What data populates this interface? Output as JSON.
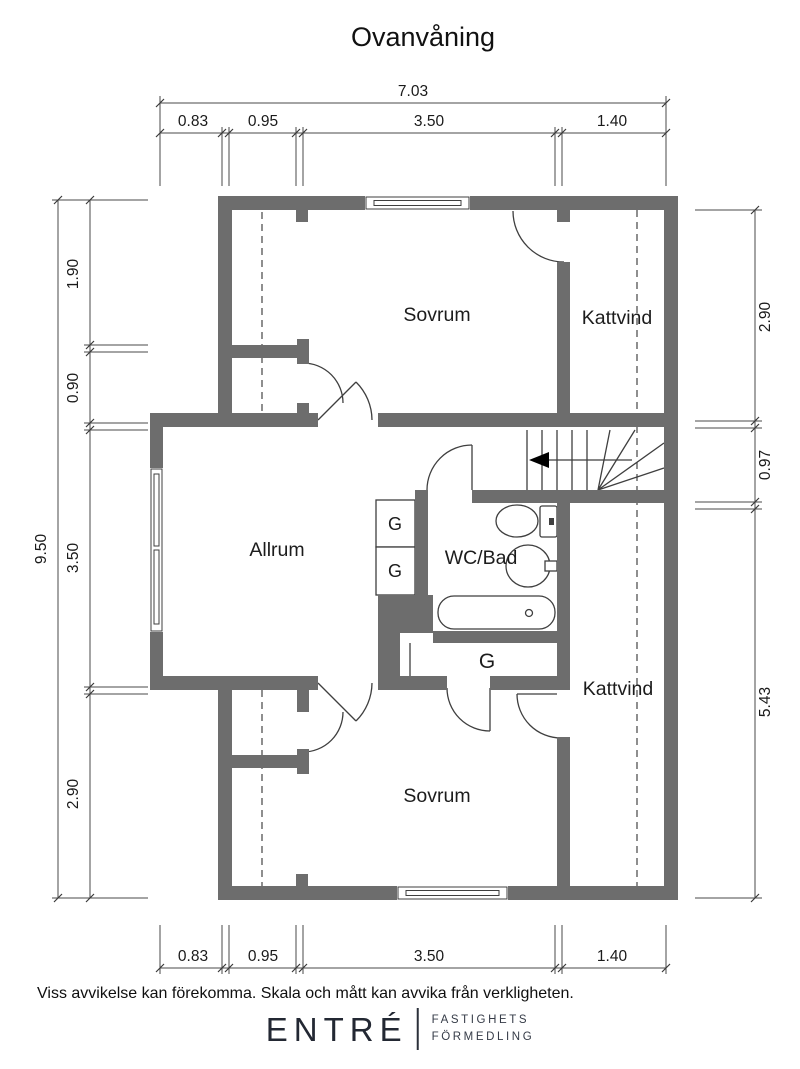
{
  "title": "Ovanvåning",
  "plan": {
    "rooms": {
      "sovrum_top": "Sovrum",
      "kattvind_top": "Kattvind",
      "allrum": "Allrum",
      "wc_bad": "WC/Bad",
      "kattvind_right": "Kattvind",
      "sovrum_bottom": "Sovrum",
      "closet_1": "G",
      "closet_2": "G",
      "closet_3": "G"
    },
    "features": [
      "stairs-with-up-arrow",
      "toilet",
      "sink",
      "bathtub",
      "windows",
      "ceiling-height-dashed-lines"
    ]
  },
  "dimensions": {
    "top": {
      "total": "7.03",
      "segments": [
        "0.83",
        "0.95",
        "3.50",
        "1.40"
      ]
    },
    "bottom": {
      "segments": [
        "0.83",
        "0.95",
        "3.50",
        "1.40"
      ]
    },
    "left": {
      "total": "9.50",
      "segments": [
        "1.90",
        "0.90",
        "3.50",
        "2.90"
      ]
    },
    "right": {
      "segments": [
        "2.90",
        "0.97",
        "5.43"
      ]
    }
  },
  "footer": {
    "disclaimer": "Viss avvikelse kan förekomma. Skala och mått kan avvika från verkligheten.",
    "brand": "ENTRÉ",
    "brand_tagline_1": "FASTIGHETS",
    "brand_tagline_2": "FÖRMEDLING"
  },
  "colors": {
    "wall": "#6d6d6d",
    "line": "#3f3f3f",
    "dash": "#5f5f5f",
    "text": "#1a1a1a"
  }
}
